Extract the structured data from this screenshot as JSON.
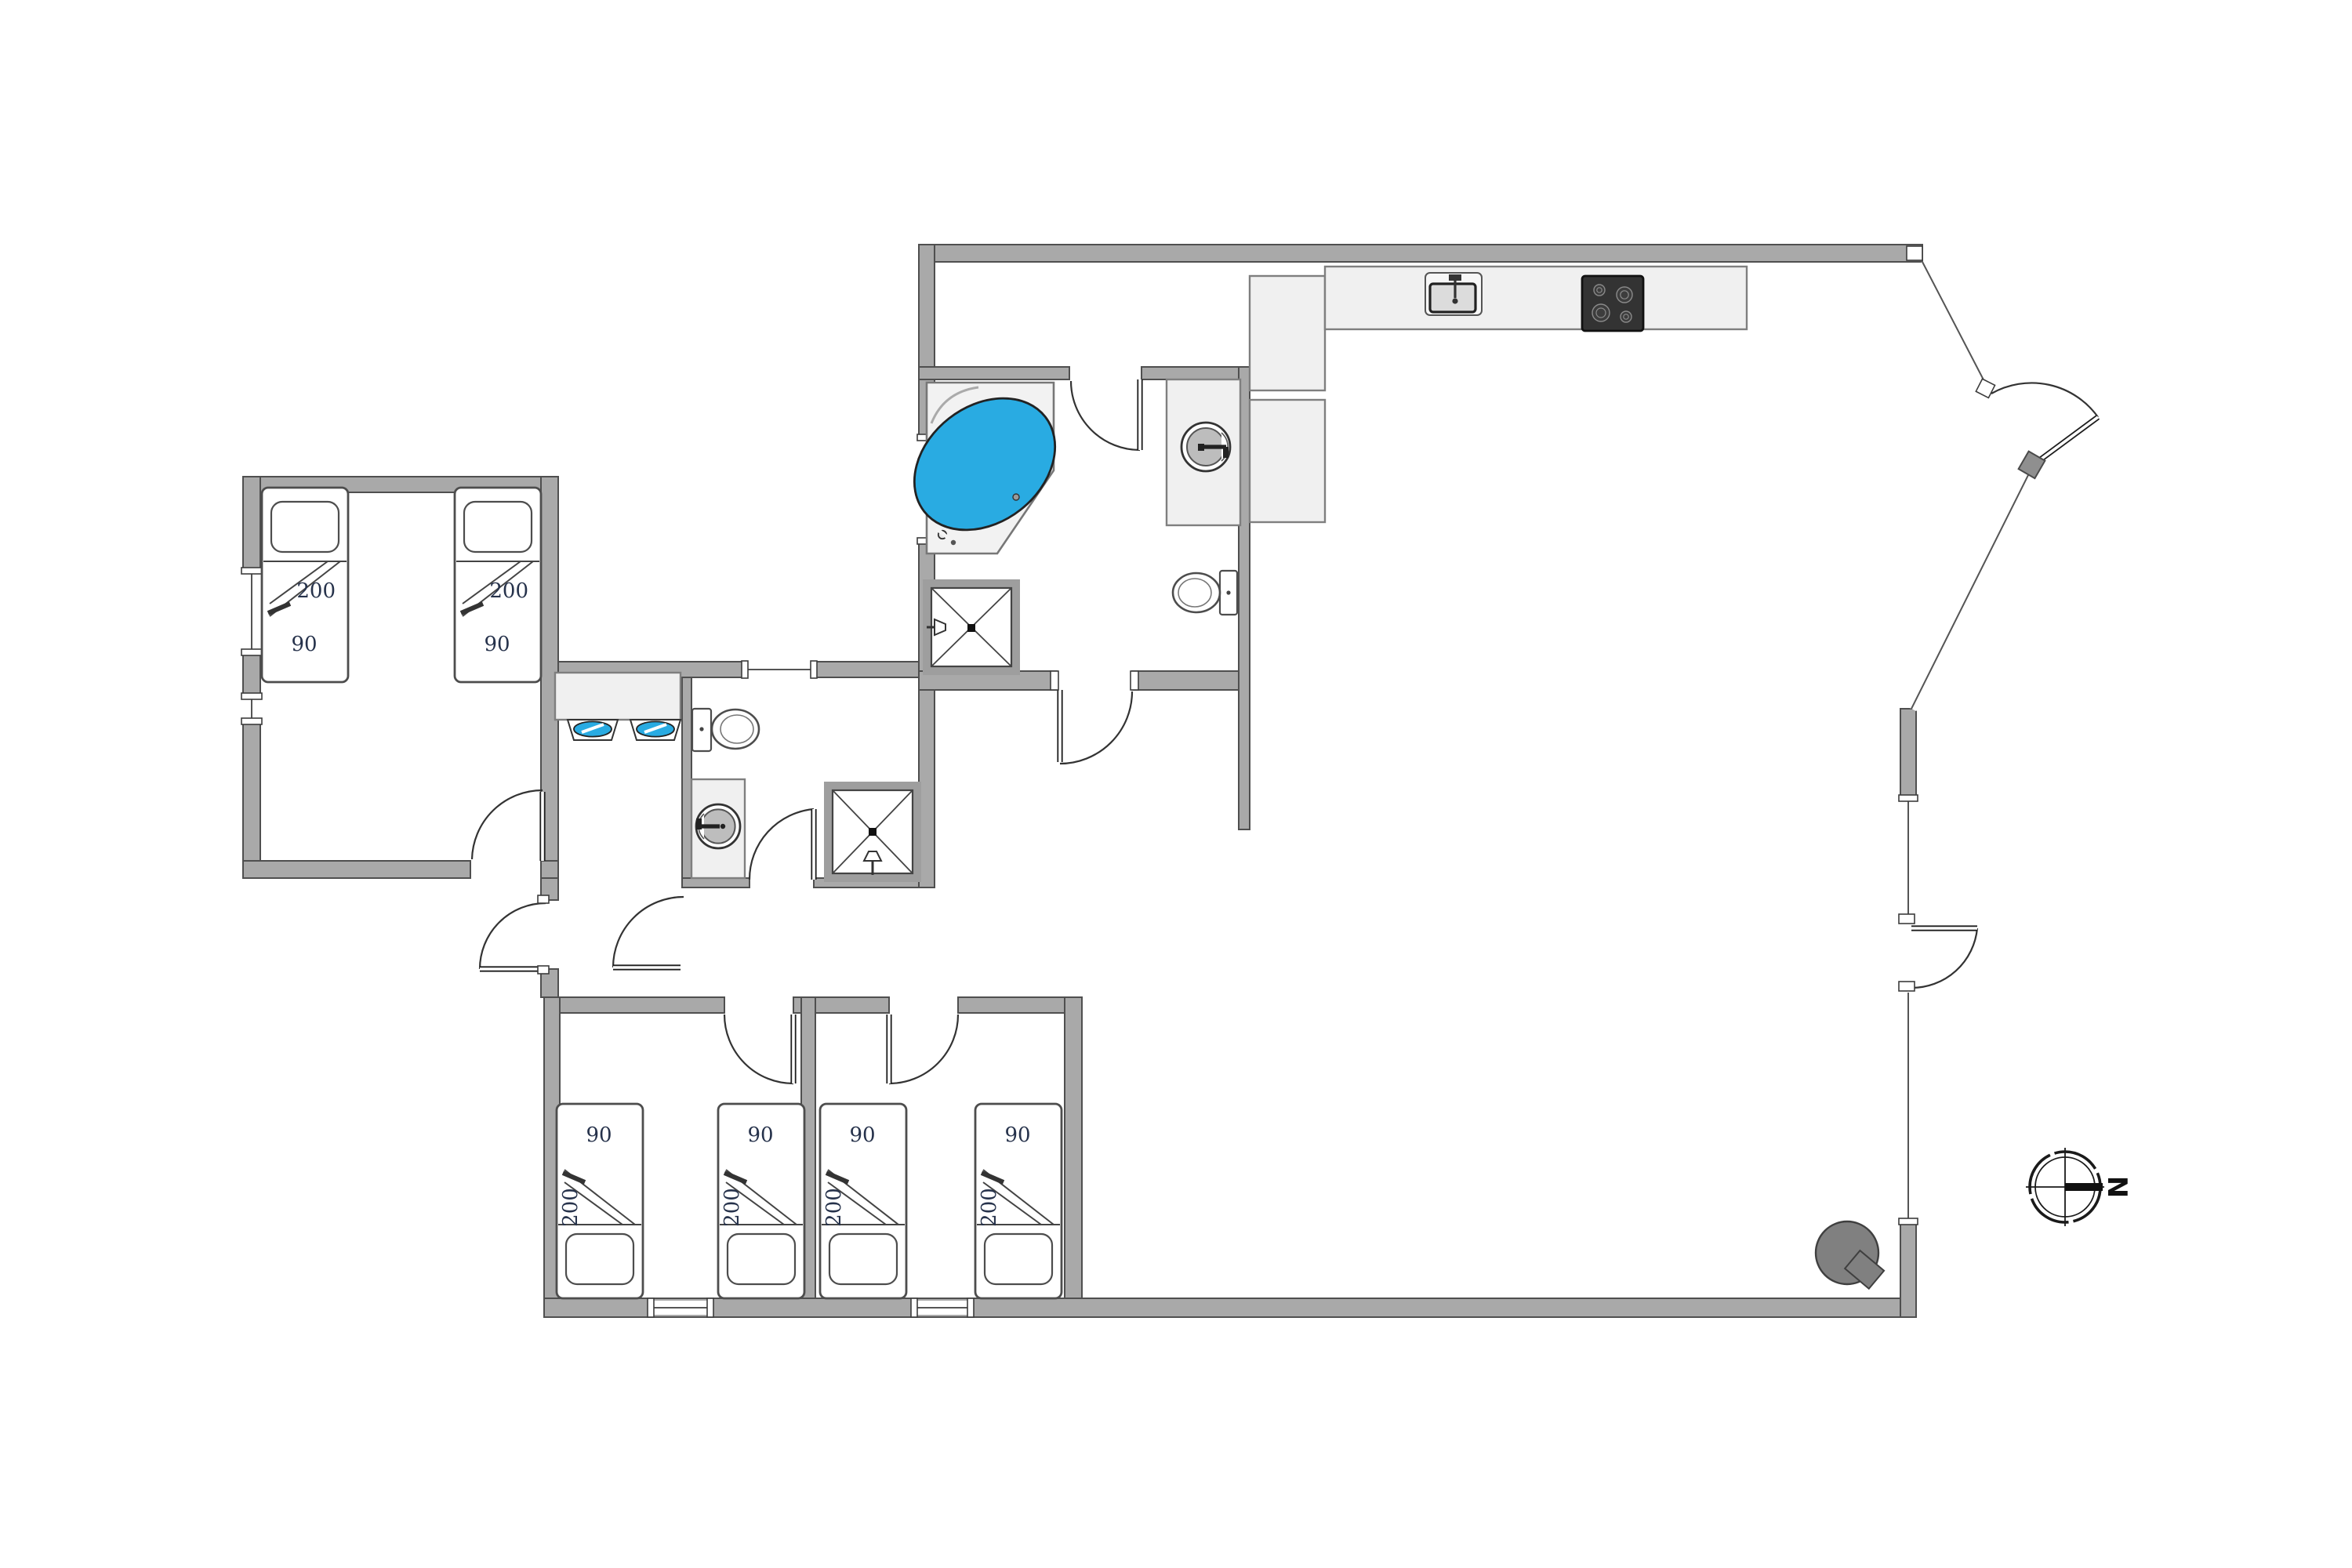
{
  "title": "holiday-house-floor-plan",
  "compass": {
    "label": "N"
  },
  "rooms": {
    "bedroom_nw": {
      "beds": [
        {
          "length": "200",
          "width": "90"
        },
        {
          "length": "200",
          "width": "90"
        }
      ]
    },
    "bedroom_s_left": {
      "beds": [
        {
          "length": "200",
          "width": "90"
        },
        {
          "length": "200",
          "width": "90"
        }
      ]
    },
    "bedroom_s_right": {
      "beds": [
        {
          "length": "200",
          "width": "90"
        },
        {
          "length": "200",
          "width": "90"
        }
      ]
    }
  },
  "fixtures": {
    "bathtub": "corner-bathtub-icon",
    "shower_main": "shower-stall-icon",
    "shower_small": "shower-stall-icon",
    "toilet_main": "toilet-icon",
    "toilet_small": "toilet-icon",
    "washing_machine_main": "washing-machine-icon",
    "washing_machine_small": "washing-machine-icon",
    "double_sink": "double-washbasin-icon",
    "kitchen_sink": "kitchen-sink-icon",
    "cooktop": "cooktop-icon",
    "wood_stove": "wood-stove-icon",
    "compass": "compass-rose-icon"
  },
  "colors": {
    "wall": "#a9a9a9",
    "wall_edge": "#4f4f4f",
    "fixture_fill": "#f0f0f0",
    "water_blue": "#29abe2",
    "cooktop_dark": "#333333",
    "stove_gray": "#808080",
    "label_text": "#26324b"
  }
}
